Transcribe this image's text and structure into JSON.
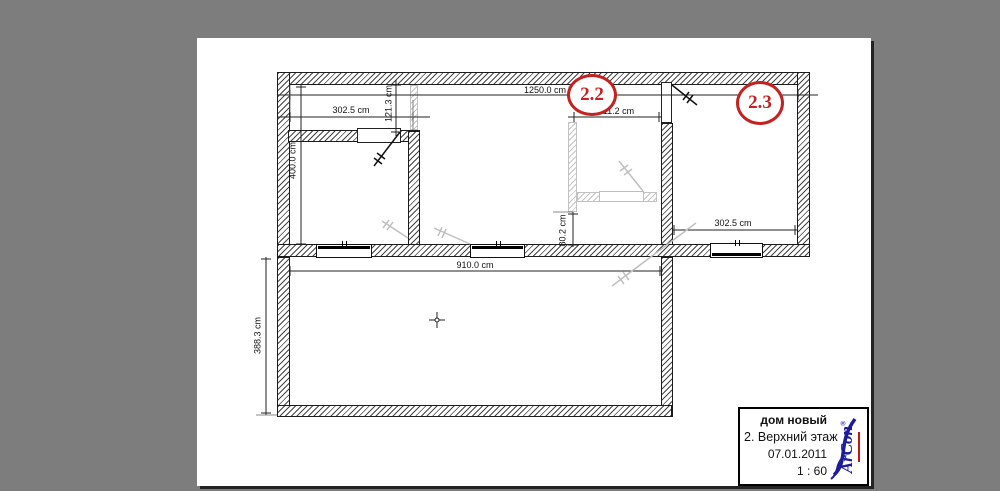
{
  "canvas": {
    "background": "#7d7d7d",
    "page_background": "#ffffff"
  },
  "plan": {
    "accent_red": "#c32222",
    "room_badges": [
      {
        "label": "2.2"
      },
      {
        "label": "2.3"
      }
    ],
    "dimensions": {
      "top_left_width": "302.5 cm",
      "corridor_depth": "121.3 cm",
      "overall_width": "1250.0 cm",
      "hall_width": "211.2 cm",
      "left_room_depth": "400.0 cm",
      "wall_gap": "80.2 cm",
      "bottom_room_width": "910.0 cm",
      "bottom_room_depth": "388.3 cm",
      "right_room_width": "302.5 cm"
    }
  },
  "title_block": {
    "project": "дом новый",
    "floor": "2. Верхний этаж",
    "date": "07.01.2011",
    "scale": "1 : 60",
    "logo_text": "ArCon",
    "logo_reg": "®",
    "logo_blue": "#1c1c9c",
    "logo_red": "#cc1111"
  }
}
